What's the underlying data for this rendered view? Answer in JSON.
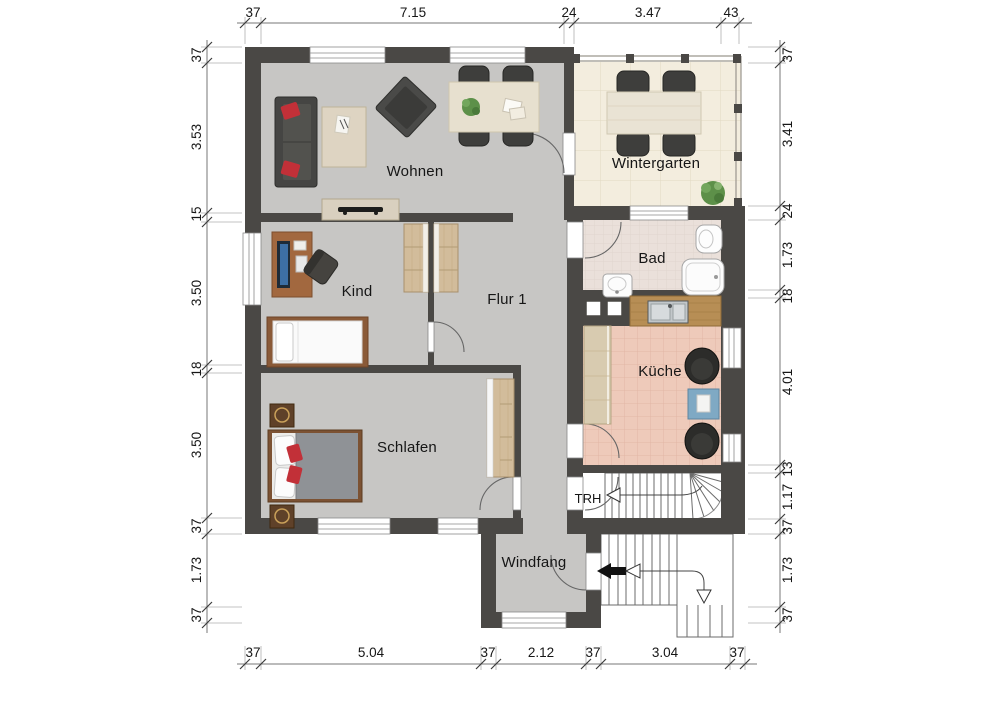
{
  "plan": {
    "title": "Erdgeschoss Grundriss",
    "rooms": {
      "wohnen": "Wohnen",
      "wintergarten": "Wintergarten",
      "bad": "Bad",
      "kind": "Kind",
      "flur": "Flur 1",
      "kueche": "Küche",
      "schlafen": "Schlafen",
      "trh": "TRH",
      "windfang": "Windfang"
    }
  },
  "dimensions": {
    "top": [
      "37",
      "7.15",
      "24",
      "3.47",
      "43"
    ],
    "bottom": [
      "37",
      "5.04",
      "37",
      "2.12",
      "37",
      "3.04",
      "37"
    ],
    "left": [
      "37",
      "3.53",
      "15",
      "3.50",
      "18",
      "3.50",
      "37",
      "1.73",
      "37"
    ],
    "right": [
      "37",
      "3.41",
      "24",
      "1.73",
      "18",
      "4.01",
      "13",
      "1.17",
      "37",
      "1.73",
      "37"
    ]
  },
  "colors": {
    "wall": "#4a4845",
    "floor_main": "#c7c6c4",
    "floor_wintergarten": "#f3edde",
    "floor_bad": "#eae0da",
    "floor_kueche": "#eecaba",
    "accent_red": "#c23038",
    "wood_light": "#ddd3c1",
    "wood_dark": "#8a5a38",
    "furniture_dark": "#3e3e3c"
  }
}
